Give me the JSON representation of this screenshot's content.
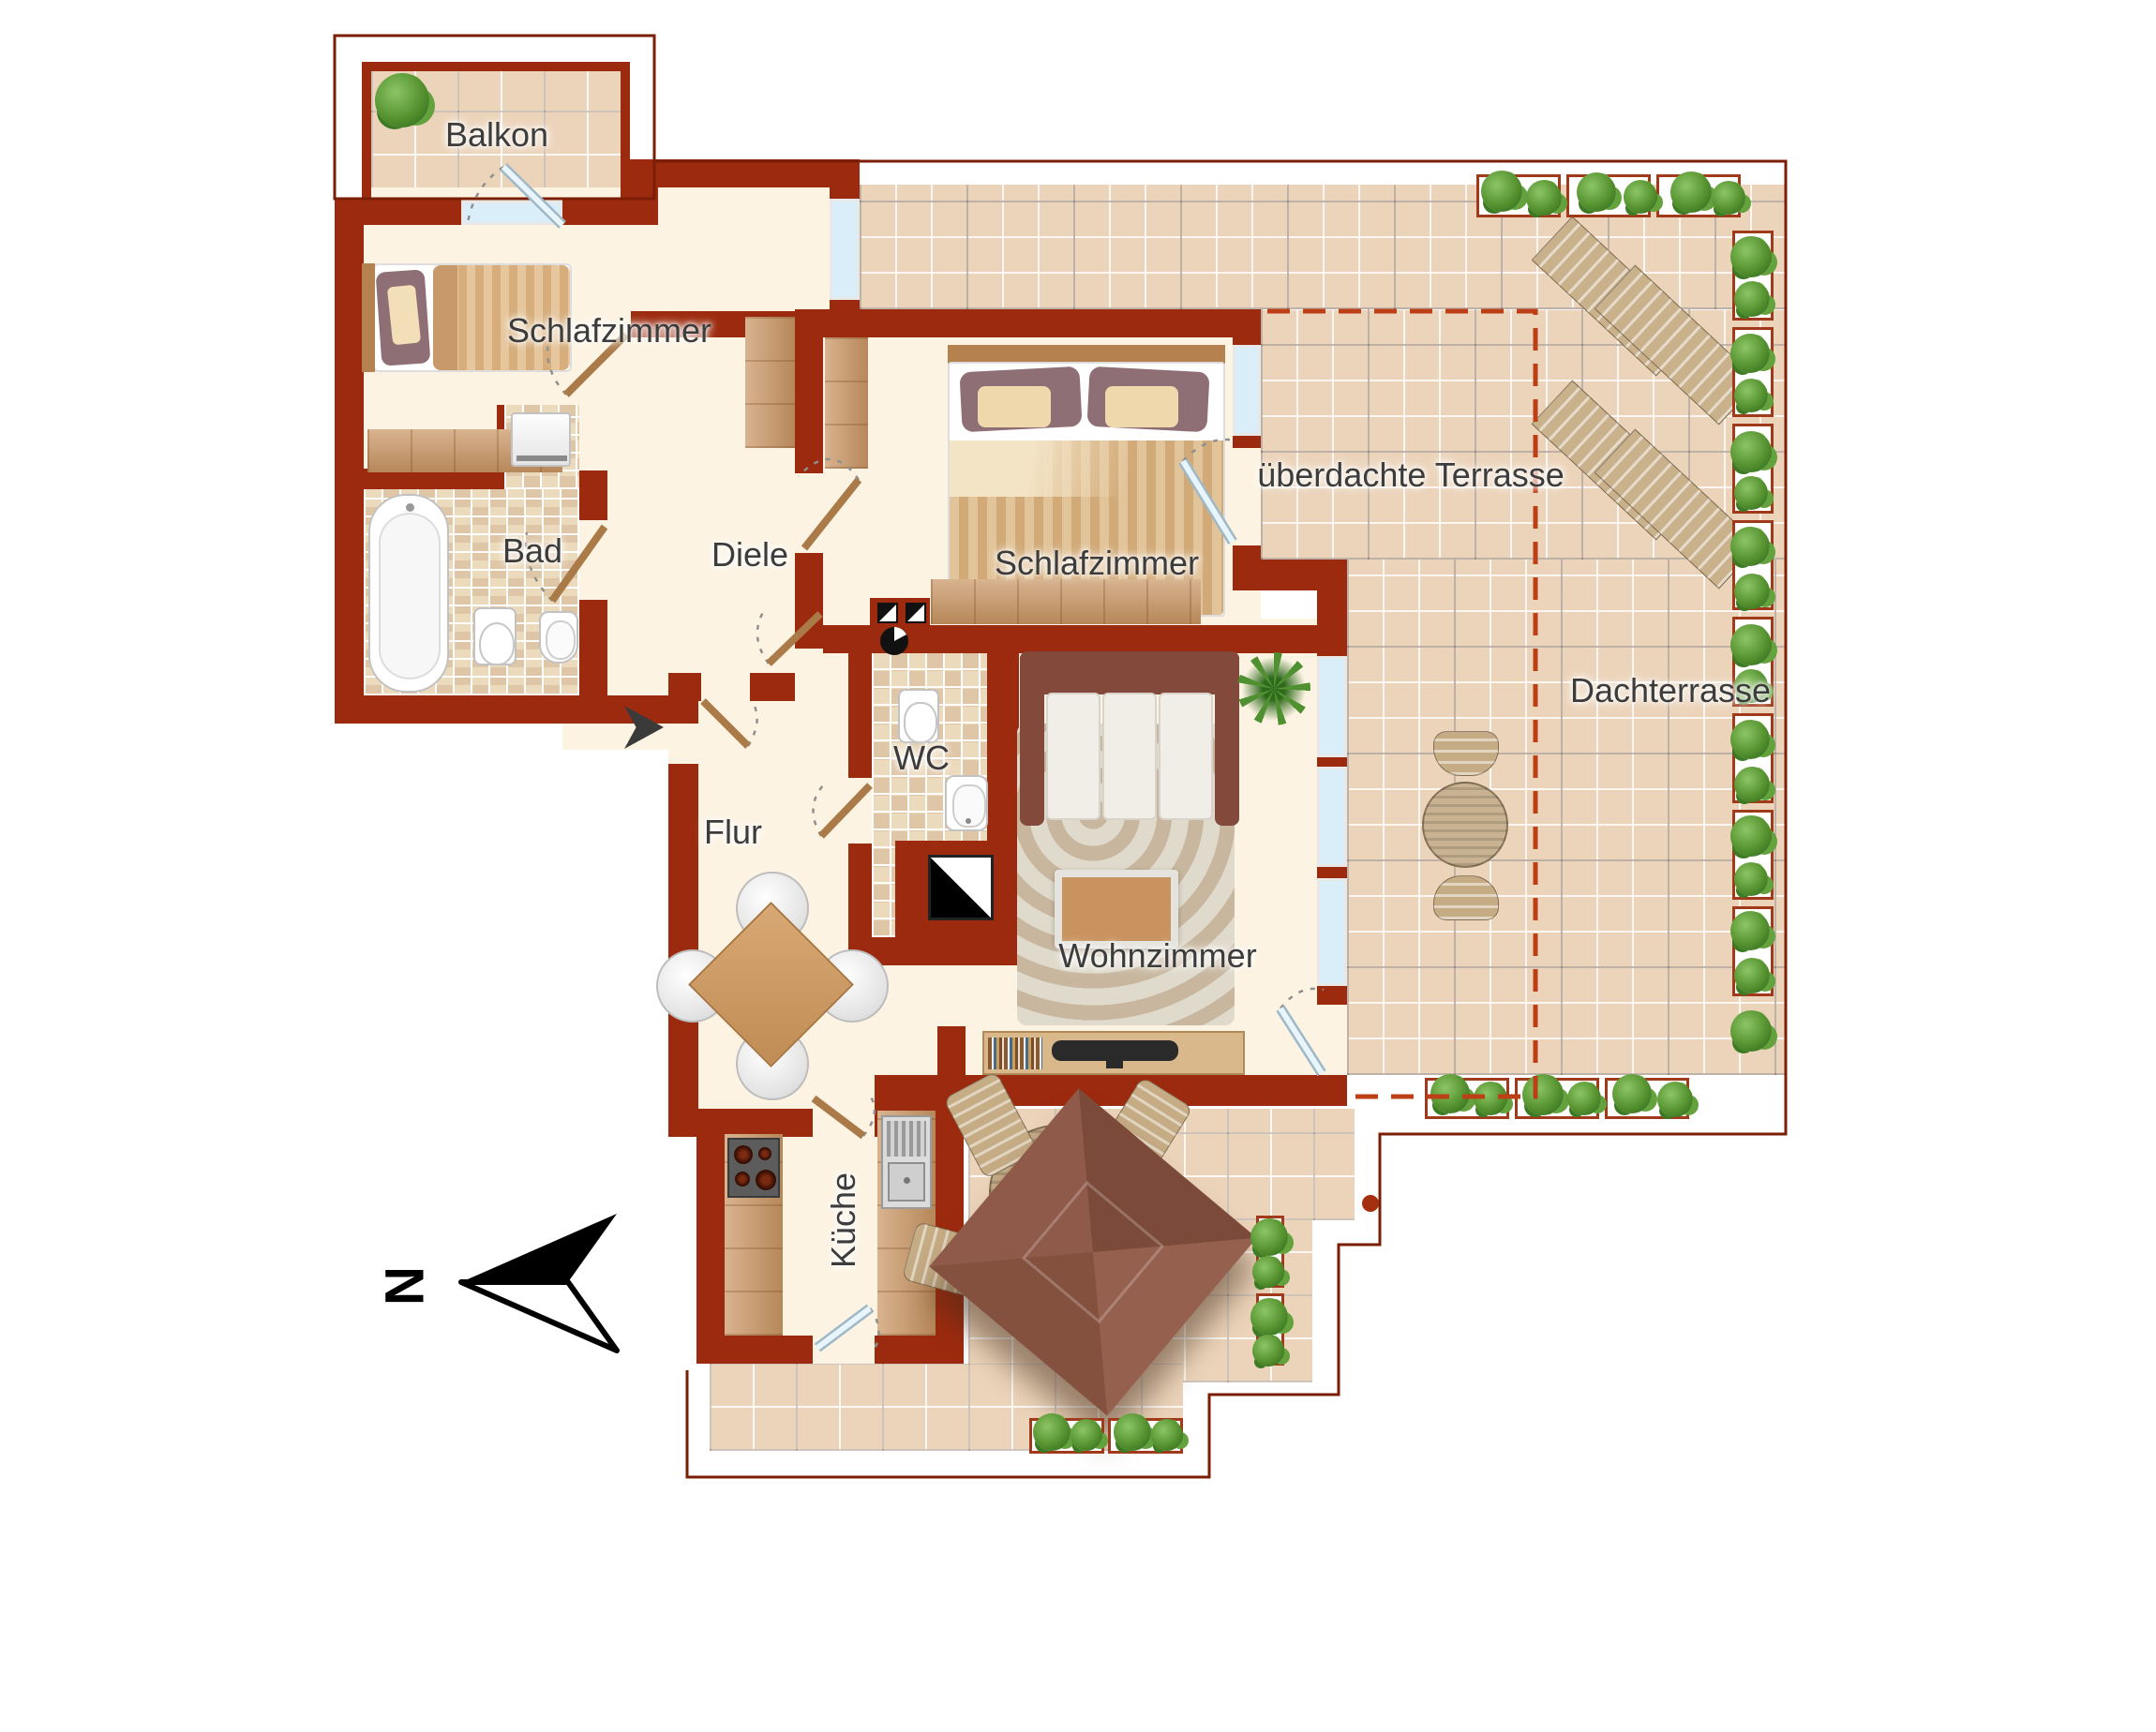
{
  "labels": {
    "balkon": "Balkon",
    "schlafzimmer_nord": "Schlafzimmer",
    "bad": "Bad",
    "diele": "Diele",
    "schlafzimmer_sued": "Schlafzimmer",
    "ueberdachte_terrasse": "überdachte Terrasse",
    "dachterrasse": "Dachterrasse",
    "wc": "WC",
    "flur": "Flur",
    "wohnzimmer": "Wohnzimmer",
    "kueche": "Küche"
  },
  "compass": {
    "north_letter": "N"
  },
  "colors": {
    "wall": "#9c2a0e",
    "outline": "#7a1e05",
    "room_floor": "#fcf3e2",
    "terrace_tile": "#ecd4ba",
    "dashed_canopy_boundary": "#bc3f16",
    "plant_green": "#55922f",
    "door_wood": "#aa7a48",
    "window_glass": "#d9eef9"
  }
}
